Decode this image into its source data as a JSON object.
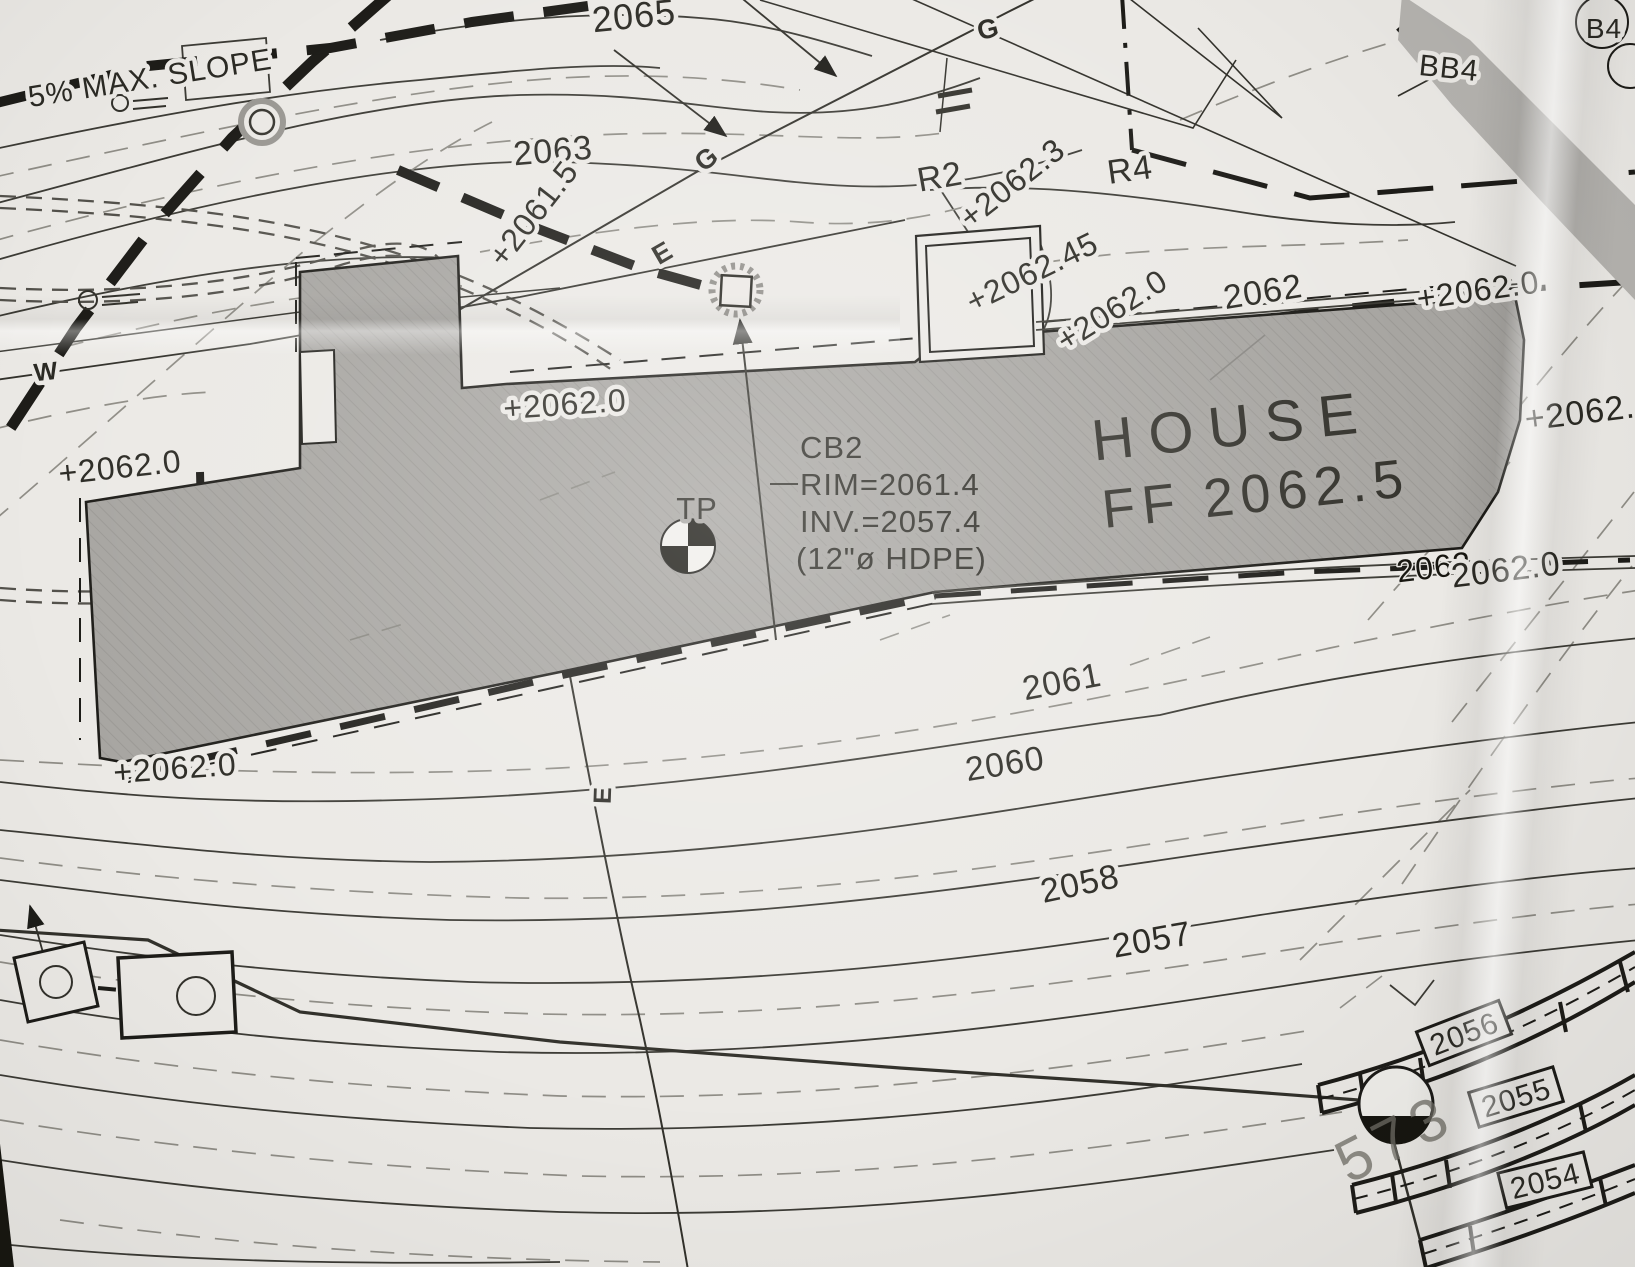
{
  "document": {
    "kind": "site-grading-plan-photo"
  },
  "colors": {
    "paper": "#ebe9e5",
    "ink": "#1d1c18",
    "house_fill": "#a7a5a1",
    "existing_contour_gray": "#8f8d86"
  },
  "symbols": {
    "catch_basin": "square-in-scalloped-circle",
    "test_pit": "quadrant-filled-circle",
    "monument": "bottom-filled-circle",
    "utility_boxes": "rect-with-circle",
    "flow_arrow": "filled-arrowhead"
  },
  "labels": {
    "slope_note": "5% MAX. SLOPE",
    "contour_2065": "2065",
    "contour_2063": "2063",
    "spot_2061_5": "+2061.5",
    "gas_g_upper": "G",
    "gas_g_lower": "G",
    "electric_e_line": "E",
    "electric_e_service": "E",
    "r2": "R2",
    "r4": "R4",
    "spot_2062_3": "+2062.3",
    "spot_2062_45": "+2062.45",
    "spot_2062_0_a": "+2062.0",
    "contour_2062_upper": "2062",
    "spot_2062_0_b": "+2062.0",
    "spot_2062_edge": "+2062.",
    "house_title": "HOUSE",
    "house_ff": "FF 2062.5",
    "spot_2062_0_c": "+2062.0",
    "cb2_name": "CB2",
    "cb2_rim": "RIM=2061.4",
    "cb2_inv": "INV.=2057.4",
    "cb2_pipe": "(12\"ø HDPE)",
    "tp": "TP",
    "spot_2062_0_d": "+2062.0",
    "spot_2062_0_e": "+2062.0",
    "contour_2062_lower": "2062",
    "spot_2062_0_f": "2062.0",
    "contour_2061": "2061",
    "contour_2060": "2060",
    "contour_2058": "2058",
    "contour_2057": "2057",
    "bb4": "BB4",
    "b4_tag": "B4",
    "wall_2056": "2056",
    "wall_2055": "2055",
    "wall_2054": "2054",
    "lot_573": "573",
    "water_w": "W"
  }
}
